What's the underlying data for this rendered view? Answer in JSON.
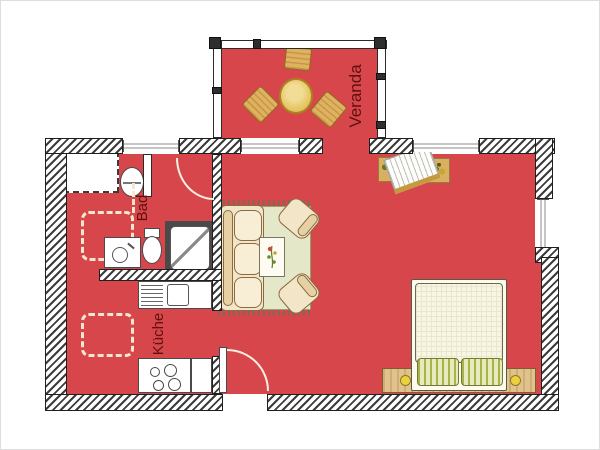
{
  "plan": {
    "type": "apartment-floor-plan",
    "background": "#ffffff",
    "floor_color": "#d7464a",
    "wall_color": "#3c3c3c",
    "label_color": "#5f1010"
  },
  "rooms": [
    {
      "id": "veranda",
      "label": "Veranda"
    },
    {
      "id": "bad",
      "label": "Bad"
    },
    {
      "id": "kueche",
      "label": "Küche"
    }
  ],
  "colors": {
    "rug": "#e4e7c8",
    "furniture_tan": "#f3e6c8",
    "wood": "#d8b060",
    "table_yellow": "#ecd27c",
    "bed_linen": "#f8f5e3",
    "pillow_green": "#e6eabc"
  },
  "furniture_icons": [
    "round-table-icon",
    "chair-icon",
    "sofa-icon",
    "armchair-icon",
    "coffee-table-icon",
    "rug-icon",
    "bed-icon",
    "pillow-icon",
    "bedside-lamp-icon",
    "plant-icon",
    "tilted-rack-icon",
    "shower-icon",
    "toilet-icon",
    "washbasin-icon",
    "oval-basin-icon",
    "closet-icon",
    "kitchen-counter-icon",
    "sink-icon",
    "stove-icon",
    "dashed-placement-icon",
    "door-swing-icon",
    "window-icon"
  ]
}
